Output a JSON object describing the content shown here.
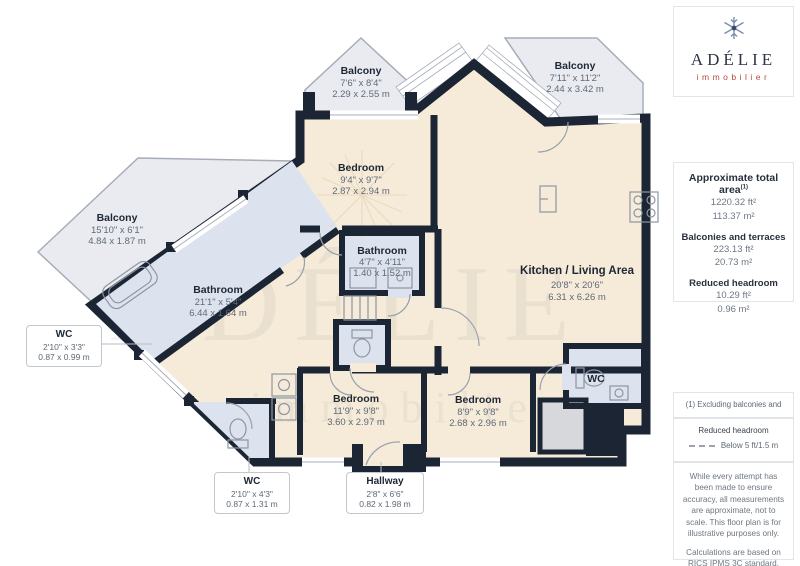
{
  "brand": {
    "name": "ADÉLIE",
    "tagline": "immobilier"
  },
  "sidebar": {
    "total_area_title": "Approximate total area",
    "total_area_sup": "(1)",
    "total_area_ft": "1220.32 ft²",
    "total_area_m": "113.37 m²",
    "balconies_title": "Balconies and terraces",
    "balconies_ft": "223.13 ft²",
    "balconies_m": "20.73 m²",
    "headroom_title": "Reduced headroom",
    "headroom_ft": "10.29 ft²",
    "headroom_m": "0.96 m²",
    "footnote": "(1) Excluding balconies and terraces",
    "legend_title": "Reduced headroom",
    "legend_entry": "Below 5 ft/1.5 m",
    "disclaimer1": "While every attempt has been made to ensure accuracy, all measurements are approximate, not to scale. This floor plan is for illustrative purposes only.",
    "disclaimer2": "Calculations are based on RICS IPMS 3C standard.",
    "giraffe_name": "GIRAFFE",
    "giraffe_number": "360"
  },
  "rooms": {
    "balcony_tl": {
      "name": "Balcony",
      "imperial": "7'6\" x 8'4\"",
      "metric": "2.29 x 2.55 m"
    },
    "balcony_tr": {
      "name": "Balcony",
      "imperial": "7'11\" x 11'2\"",
      "metric": "2.44 x 3.42 m"
    },
    "balcony_left": {
      "name": "Balcony",
      "imperial": "15'10\" x 6'1\"",
      "metric": "4.84 x 1.87 m"
    },
    "bedroom_top": {
      "name": "Bedroom",
      "imperial": "9'4\" x 9'7\"",
      "metric": "2.87 x 2.94 m"
    },
    "bathroom_mid": {
      "name": "Bathroom",
      "imperial": "4'7\" x 4'11\"",
      "metric": "1.40 x 1.52 m"
    },
    "kitchen": {
      "name": "Kitchen / Living Area",
      "imperial": "20'8\" x 20'6\"",
      "metric": "6.31 x 6.26 m"
    },
    "bathroom_left": {
      "name": "Bathroom",
      "imperial": "21'1\" x 5'4\"",
      "metric": "6.44 x 1.64 m"
    },
    "bedroom_bl": {
      "name": "Bedroom",
      "imperial": "11'9\" x 9'8\"",
      "metric": "3.60 x 2.97 m"
    },
    "bedroom_br": {
      "name": "Bedroom",
      "imperial": "8'9\" x 9'8\"",
      "metric": "2.68 x 2.96 m"
    },
    "wc_right": {
      "name": "WC"
    }
  },
  "callouts": {
    "wc_left": {
      "name": "WC",
      "imperial": "2'10\" x 3'3\"",
      "metric": "0.87 x 0.99 m"
    },
    "wc_bottom": {
      "name": "WC",
      "imperial": "2'10\" x 4'3\"",
      "metric": "0.87 x 1.31 m"
    },
    "hallway": {
      "name": "Hallway",
      "imperial": "2'8\" x 6'6\"",
      "metric": "0.82 x 1.98 m"
    }
  },
  "watermark": {
    "line1": "ADÉLIE",
    "line2": "immobilier"
  },
  "colors": {
    "wall": "#1c2534",
    "floor": "#f6ebd8",
    "wet": "#dde3ee",
    "balcony": "#e9ebf0",
    "accent": "#b5473c"
  }
}
